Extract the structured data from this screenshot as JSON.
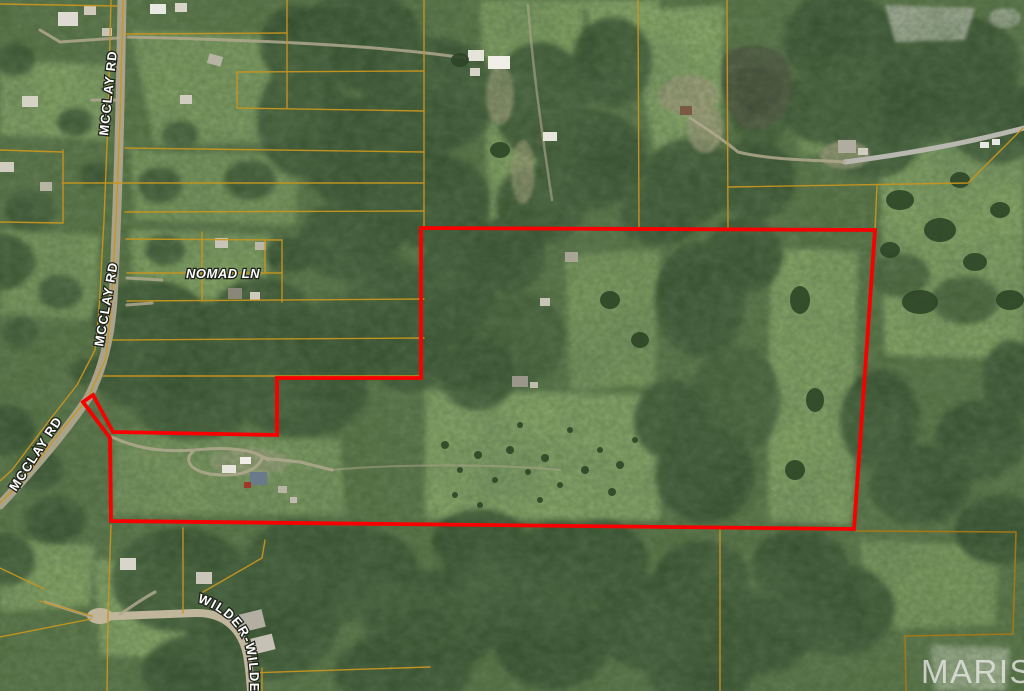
{
  "map": {
    "type": "aerial parcel map with highlighted property boundary",
    "watermark": "MARIS",
    "labels": {
      "mcclay_top": "MCCLAY RD",
      "mcclay_mid": "MCCLAY RD",
      "mcclay_diag": "MCCLAY RD",
      "nomad": "NOMAD LN",
      "wilder": "WILDER-WILDE"
    },
    "boundary": {
      "points": "93,395 113,432 277,435 277,378 421,378 421,228 875,230 854,529 111,521 110,438 83,402",
      "color": "#f80000"
    },
    "colors": {
      "parcel": "#c8951f",
      "parcel_dark": "#a87816",
      "forest": "#283f22",
      "field": "#84a561",
      "road": "#aaa38c"
    }
  }
}
